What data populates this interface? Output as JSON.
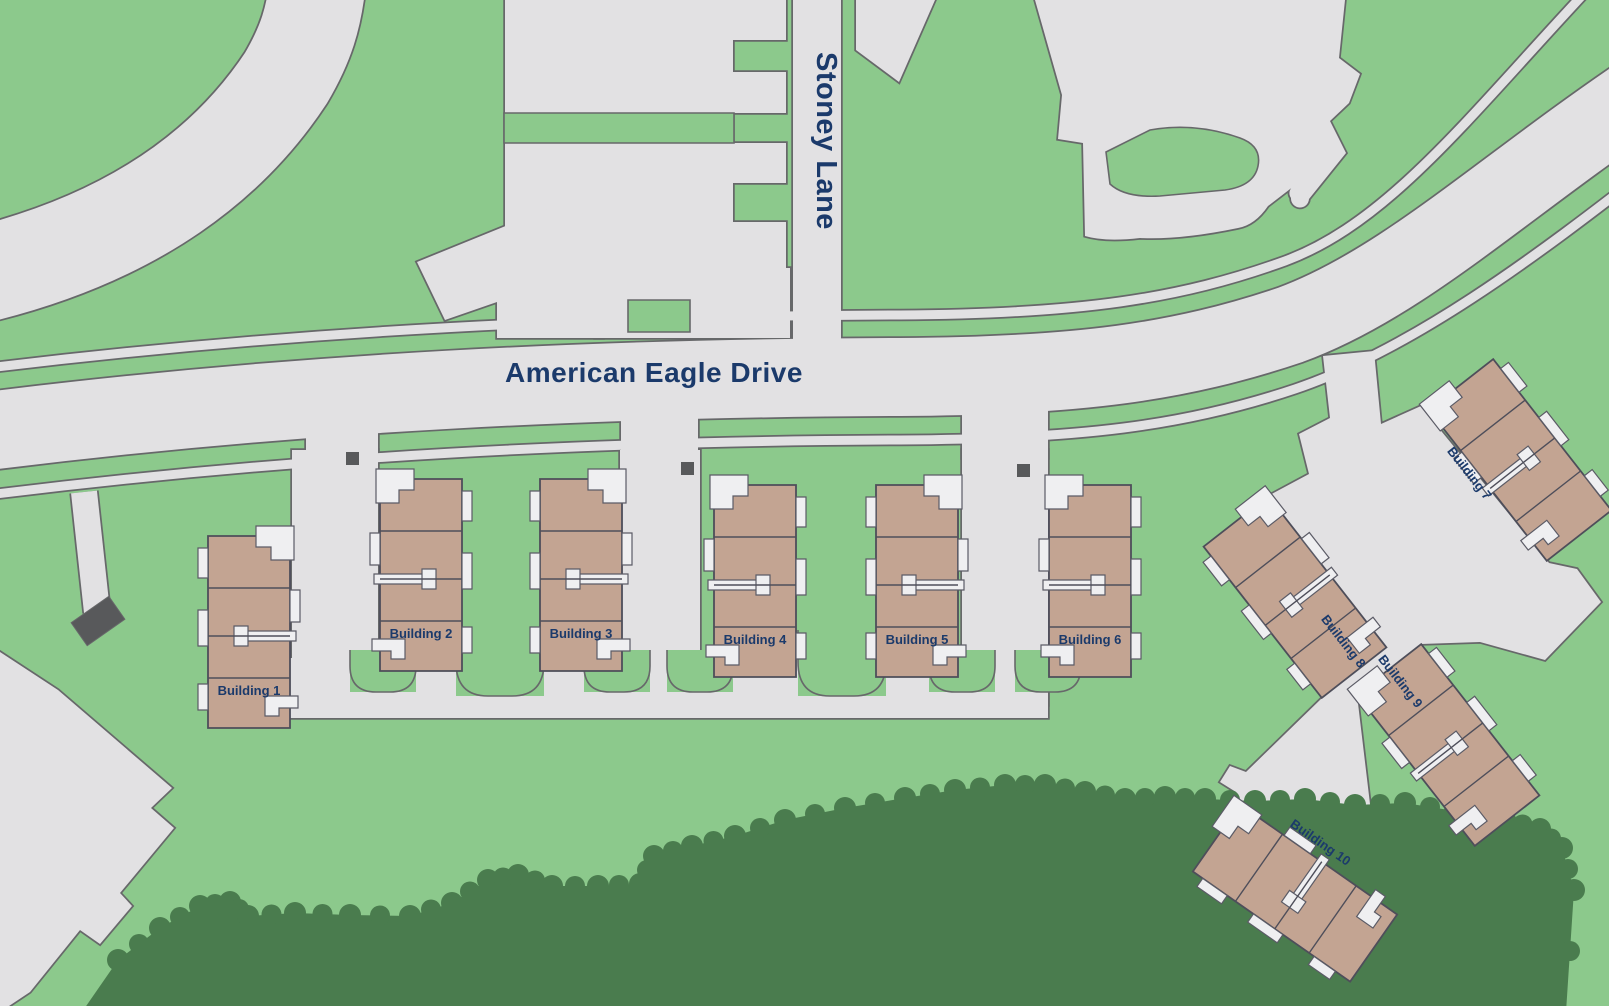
{
  "map": {
    "streets": {
      "main": "American Eagle Drive",
      "cross": "Stoney Lane"
    },
    "buildings": [
      {
        "id": "building-1",
        "label": "Building 1",
        "cx": 249,
        "cy": 632,
        "rotate": 0,
        "mirror": true,
        "label_inside": true
      },
      {
        "id": "building-2",
        "label": "Building 2",
        "cx": 421,
        "cy": 575,
        "rotate": 0,
        "mirror": false,
        "label_inside": true
      },
      {
        "id": "building-3",
        "label": "Building 3",
        "cx": 581,
        "cy": 575,
        "rotate": 0,
        "mirror": true,
        "label_inside": true
      },
      {
        "id": "building-4",
        "label": "Building 4",
        "cx": 755,
        "cy": 581,
        "rotate": 0,
        "mirror": false,
        "label_inside": true
      },
      {
        "id": "building-5",
        "label": "Building 5",
        "cx": 917,
        "cy": 581,
        "rotate": 0,
        "mirror": true,
        "label_inside": true
      },
      {
        "id": "building-6",
        "label": "Building 6",
        "cx": 1090,
        "cy": 581,
        "rotate": 0,
        "mirror": false,
        "label_inside": true
      },
      {
        "id": "building-7",
        "label": "Building 7",
        "cx": 1520,
        "cy": 460,
        "rotate": -38,
        "mirror": false,
        "label_inside": false,
        "lx": 1466,
        "ly": 476,
        "langle": 52
      },
      {
        "id": "building-8",
        "label": "Building 8",
        "cx": 1295,
        "cy": 597,
        "rotate": -38,
        "mirror": true,
        "label_inside": false,
        "lx": 1340,
        "ly": 644,
        "langle": 52
      },
      {
        "id": "building-9",
        "label": "Building 9",
        "cx": 1448,
        "cy": 745,
        "rotate": -38,
        "mirror": false,
        "label_inside": false,
        "lx": 1397,
        "ly": 684,
        "langle": 52
      },
      {
        "id": "building-10",
        "label": "Building 10",
        "cx": 1295,
        "cy": 893,
        "rotate": -55,
        "mirror": true,
        "label_inside": false,
        "lx": 1318,
        "ly": 846,
        "langle": 35
      }
    ],
    "palette": {
      "grass": "#8CC98C",
      "forest": "#4A7C4E",
      "road": "#E2E1E3",
      "casing": "#67686A",
      "building": "#C3A492",
      "building_line": "#4E4E5A",
      "walk": "#EFEFF1",
      "walk_line": "#5B5B66",
      "label": "#1B3A6B",
      "dumpster": "#58595B"
    }
  }
}
